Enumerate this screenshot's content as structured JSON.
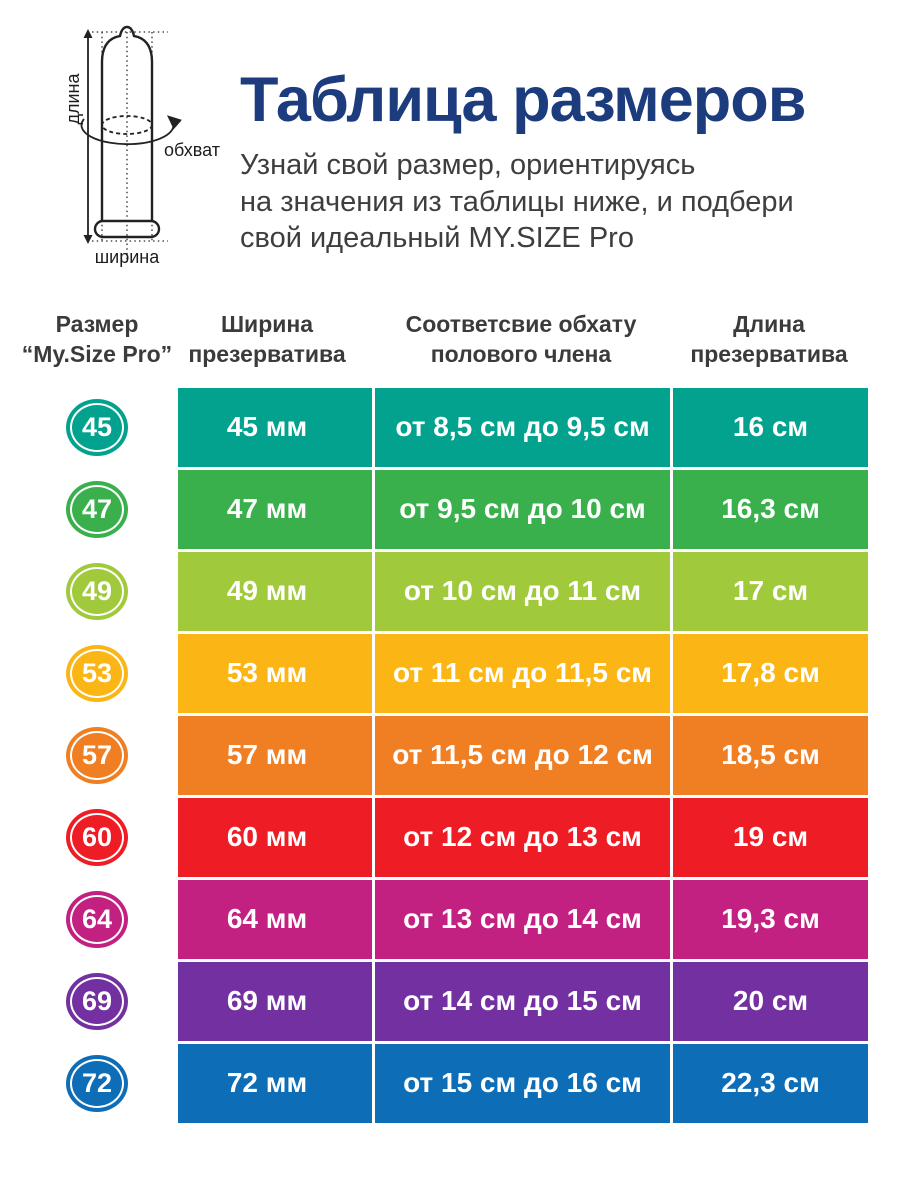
{
  "hero": {
    "title": "Таблица размеров",
    "title_color": "#1c3c7e",
    "subtitle_lines": [
      "Узнай свой размер, ориентируясь",
      "на значения из таблицы ниже, и подбери",
      "свой идеальный MY.SIZE Pro"
    ]
  },
  "diagram": {
    "length_label": "длина",
    "girth_label": "обхват",
    "width_label": "ширина"
  },
  "table": {
    "headers": [
      {
        "line1": "Размер",
        "line2": "“My.Size Pro”"
      },
      {
        "line1": "Ширина",
        "line2": "презерватива"
      },
      {
        "line1": "Соответсвие обхату",
        "line2": "полового члена"
      },
      {
        "line1": "Длина",
        "line2": "презерватива"
      }
    ],
    "rows": [
      {
        "size": "45",
        "color": "#02a28e",
        "width": "45 мм",
        "girth": "от 8,5 см до 9,5 см",
        "length": "16 см"
      },
      {
        "size": "47",
        "color": "#3ab04c",
        "width": "47 мм",
        "girth": "от 9,5 см до 10 см",
        "length": "16,3 см"
      },
      {
        "size": "49",
        "color": "#a0ca3c",
        "width": "49 мм",
        "girth": "от 10 см до 11 см",
        "length": "17 см"
      },
      {
        "size": "53",
        "color": "#fbb515",
        "width": "53 мм",
        "girth": "от 11 см до 11,5 см",
        "length": "17,8 см"
      },
      {
        "size": "57",
        "color": "#f07e22",
        "width": "57 мм",
        "girth": "от 11,5 см до 12 см",
        "length": "18,5 см"
      },
      {
        "size": "60",
        "color": "#ee1c24",
        "width": "60 мм",
        "girth": "от 12 см до 13 см",
        "length": "19 см"
      },
      {
        "size": "64",
        "color": "#c32182",
        "width": "64 мм",
        "girth": "от 13 см до 14 см",
        "length": "19,3 см"
      },
      {
        "size": "69",
        "color": "#7230a0",
        "width": "69 мм",
        "girth": "от 14 см до 15 см",
        "length": "20 см"
      },
      {
        "size": "72",
        "color": "#0d6db6",
        "width": "72 мм",
        "girth": "от 15 см до 16 см",
        "length": "22,3 см"
      }
    ]
  },
  "chart_data": {
    "type": "table",
    "title": "Таблица размеров",
    "columns": [
      "Размер “My.Size Pro”",
      "Ширина презерватива",
      "Соответсвие обхату полового члена",
      "Длина презерватива"
    ],
    "rows": [
      [
        "45",
        "45 мм",
        "от 8,5 см до 9,5 см",
        "16 см"
      ],
      [
        "47",
        "47 мм",
        "от 9,5 см до 10 см",
        "16,3 см"
      ],
      [
        "49",
        "49 мм",
        "от 10 см до 11 см",
        "17 см"
      ],
      [
        "53",
        "53 мм",
        "от 11 см до 11,5 см",
        "17,8 см"
      ],
      [
        "57",
        "57 мм",
        "от 11,5 см до 12 см",
        "18,5 см"
      ],
      [
        "60",
        "60 мм",
        "от 12 см до 13 см",
        "19 см"
      ],
      [
        "64",
        "64 мм",
        "от 13 см до 14 см",
        "19,3 см"
      ],
      [
        "69",
        "69 мм",
        "от 14 см до 15 см",
        "20 см"
      ],
      [
        "72",
        "72 мм",
        "от 15 см до 16 см",
        "22,3 см"
      ]
    ],
    "row_colors": [
      "#02a28e",
      "#3ab04c",
      "#a0ca3c",
      "#fbb515",
      "#f07e22",
      "#ee1c24",
      "#c32182",
      "#7230a0",
      "#0d6db6"
    ]
  }
}
